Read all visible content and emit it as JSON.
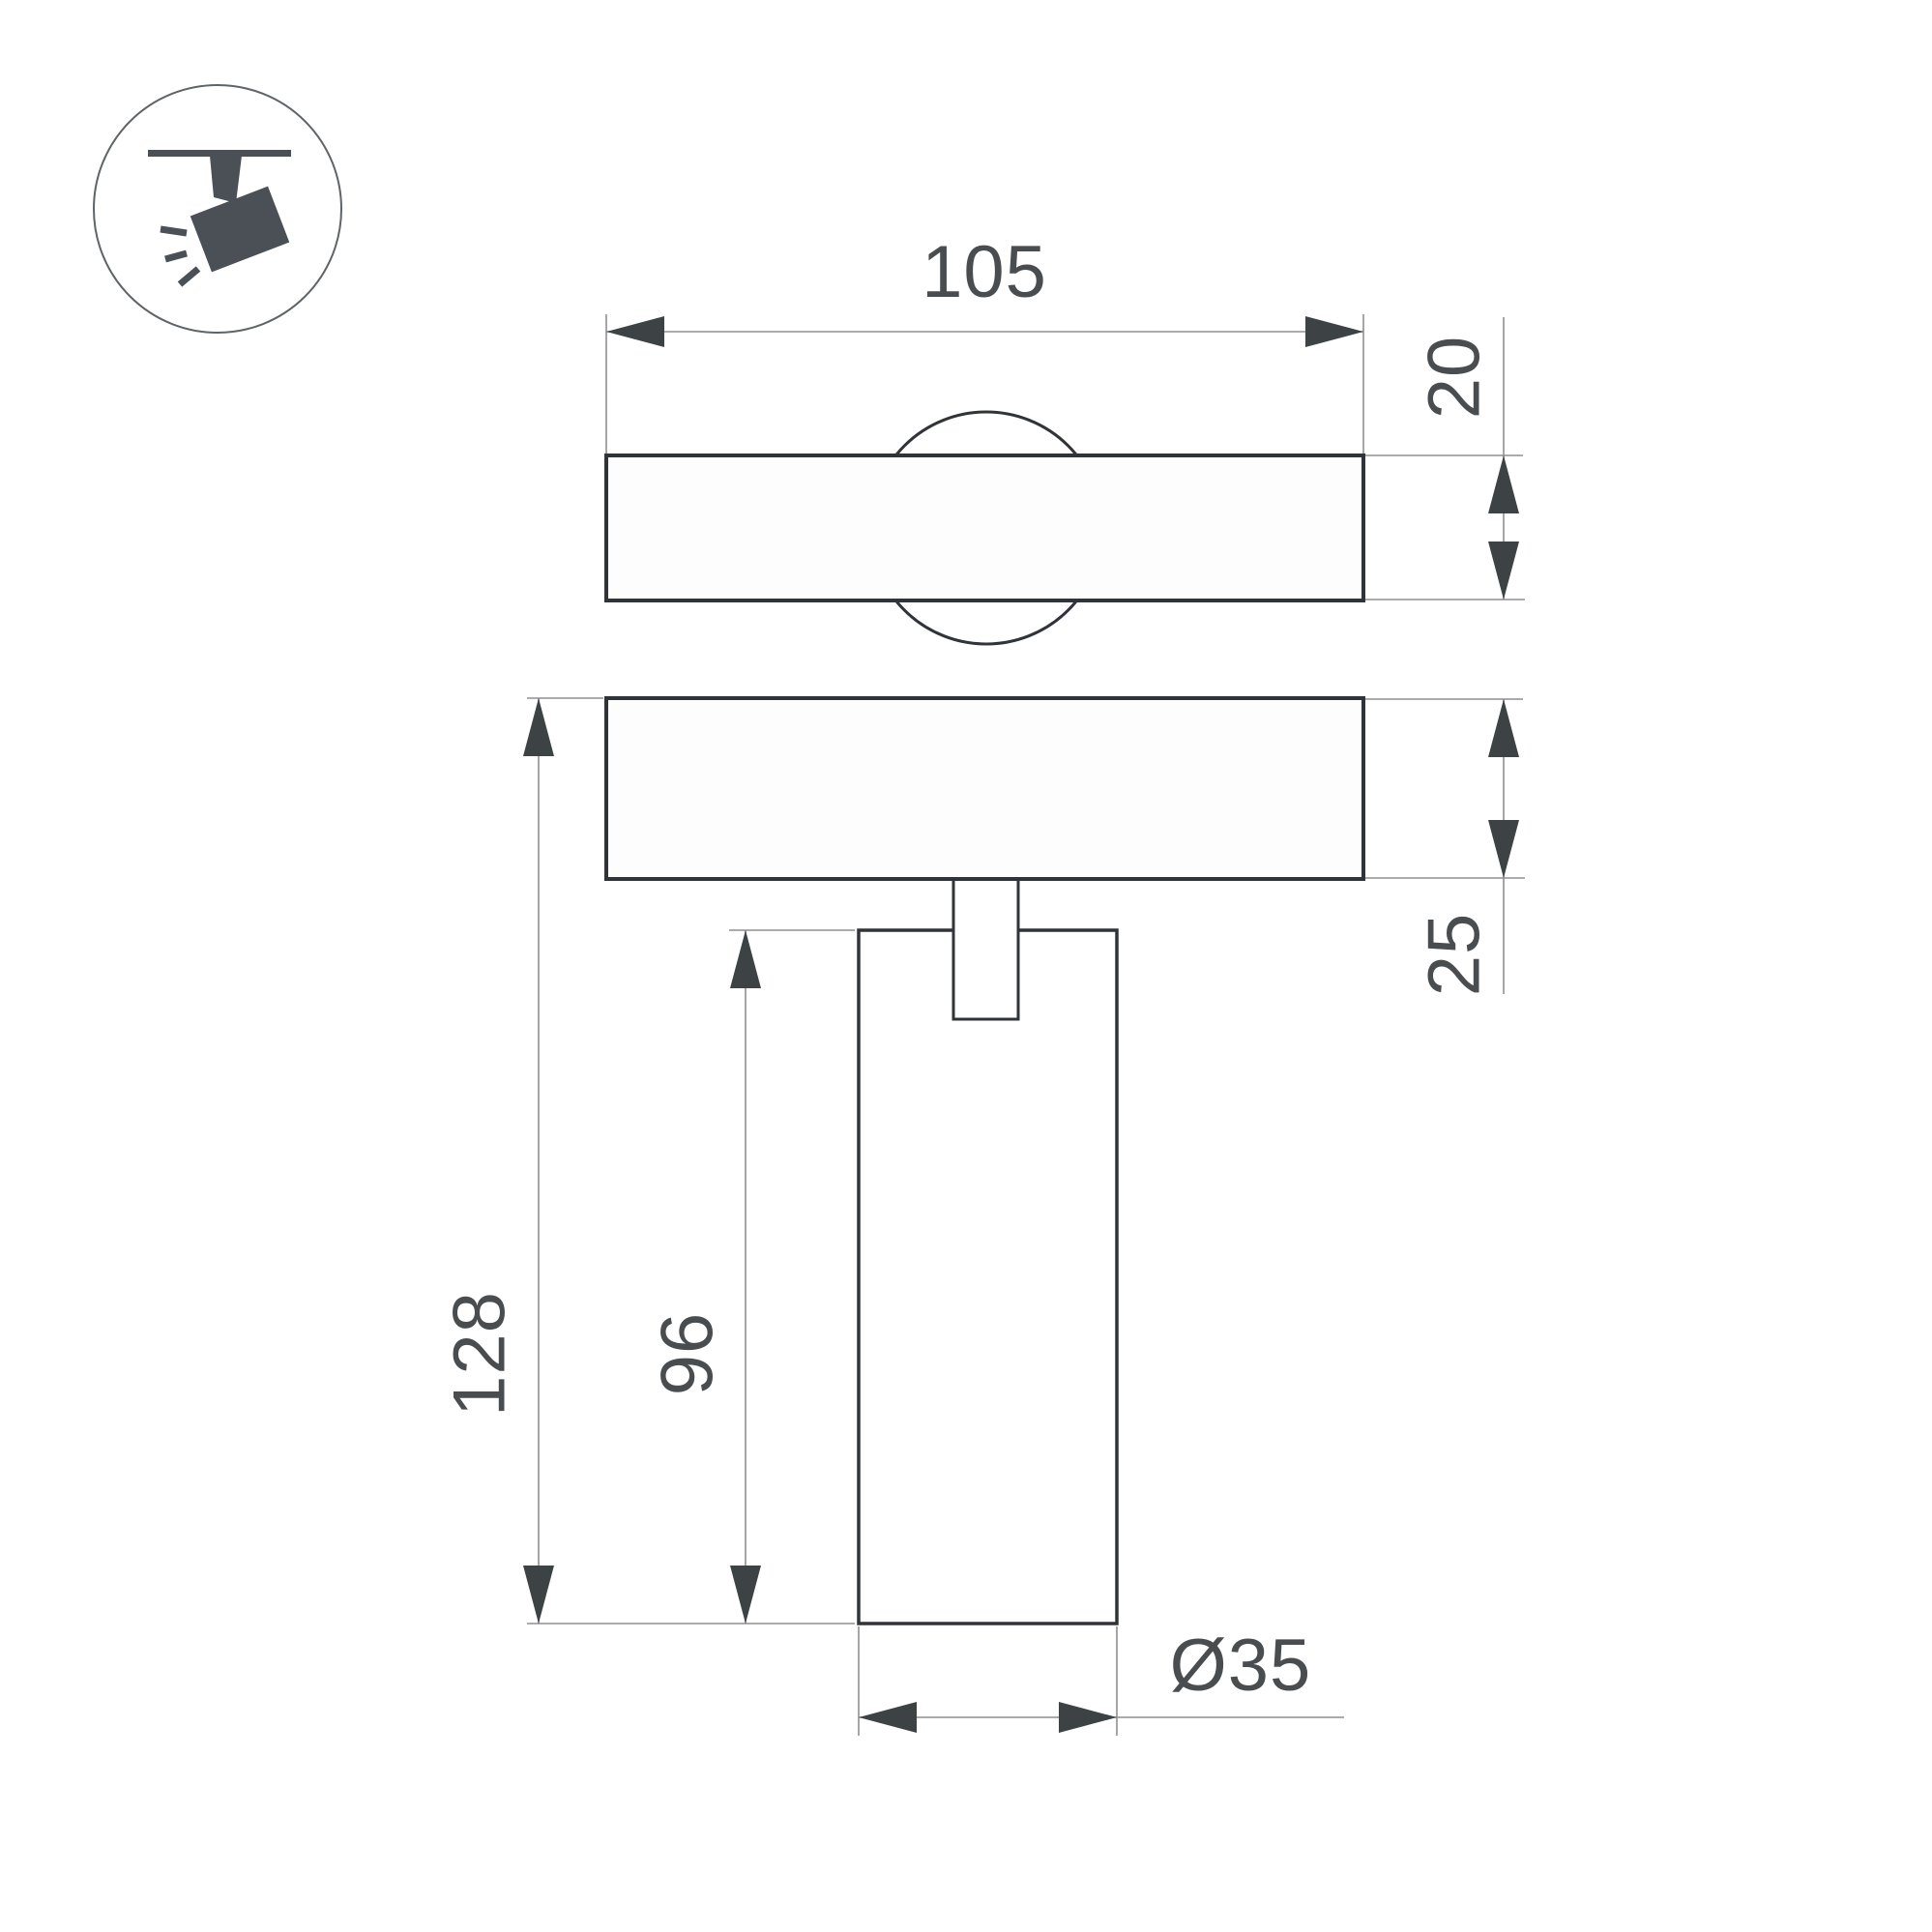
{
  "page": {
    "background": "#ffffff"
  },
  "icon": {
    "name": "track-spotlight",
    "glyph_color": "#4a5056",
    "circle_color": "#5f6468"
  },
  "drawing": {
    "type": "technical-dimension-drawing",
    "views": [
      "top-view-of-track-plate",
      "front-view-with-cylindrical-spot-body"
    ],
    "colors": {
      "outline": "#303438",
      "dimension_lines": "#8f8f8f",
      "arrows": "#3d4245",
      "text": "#4a4d50"
    },
    "dims": {
      "top_width": "105",
      "top_view_height": "20",
      "base_height": "25",
      "overall_height": "128",
      "body_height": "96",
      "body_diameter": "Ø35"
    }
  }
}
